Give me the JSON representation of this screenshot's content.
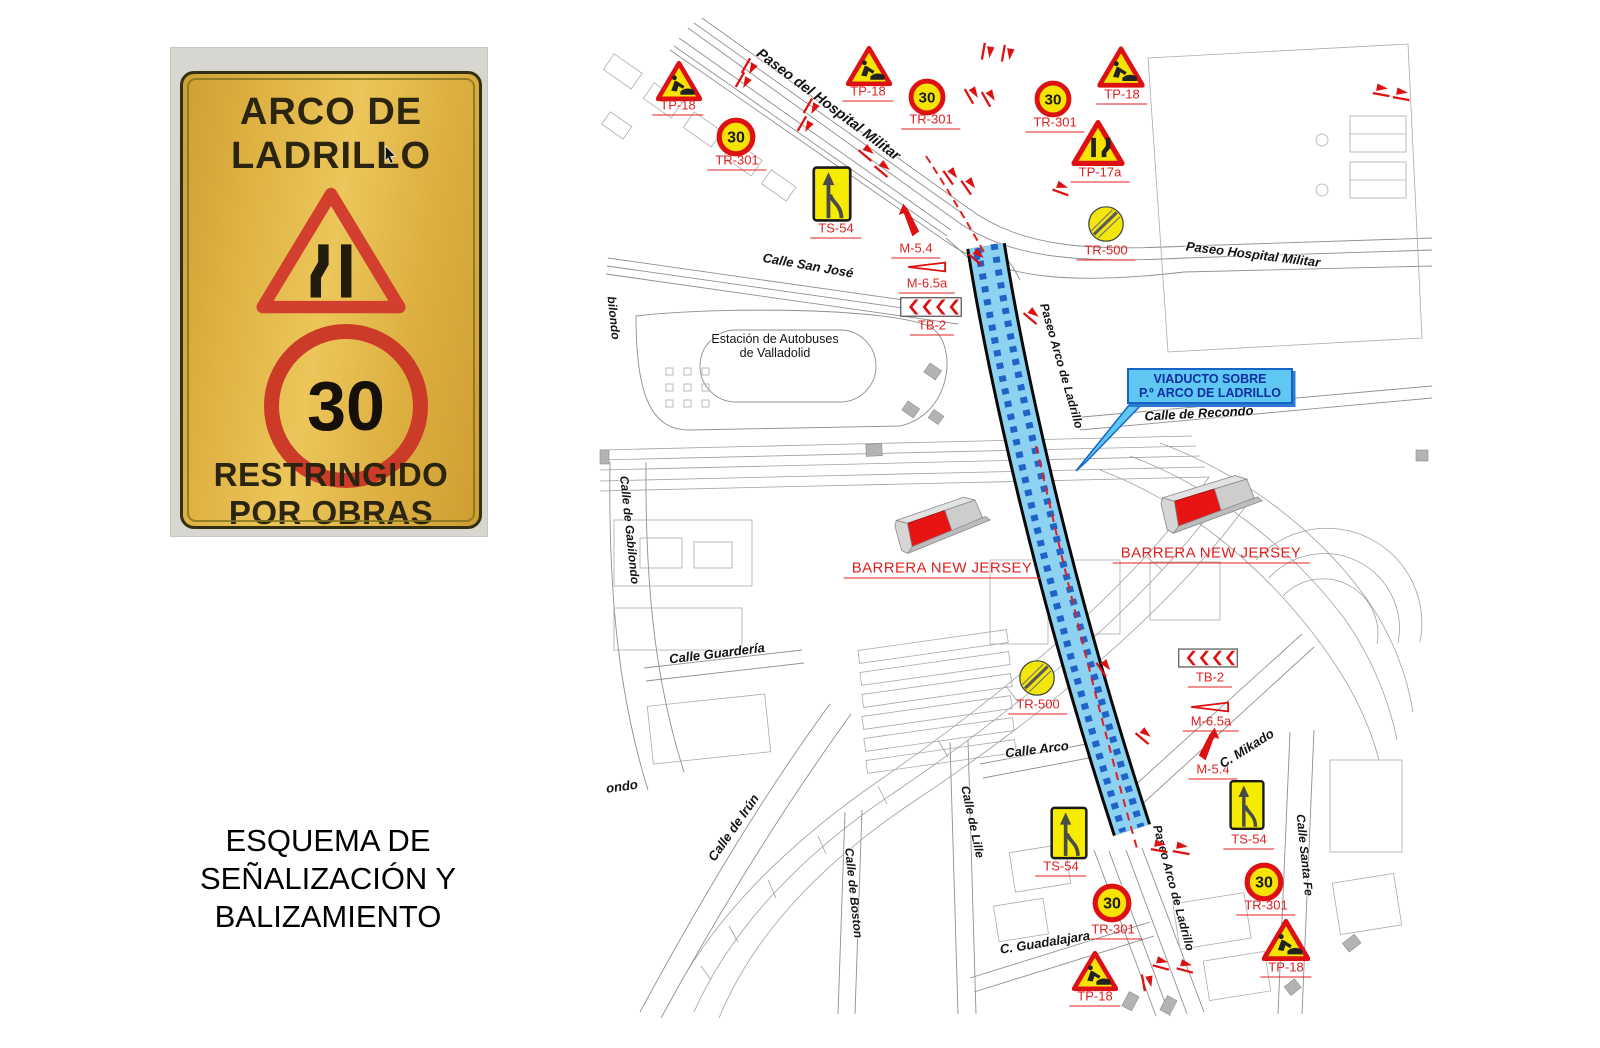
{
  "colors": {
    "accent_red": "#dd1111",
    "sign_yellow": "#f6e300",
    "label_red": "#e02020",
    "viaduct_fill": "#8ed2f2",
    "viaduct_dash": "#1f63c8",
    "callout_bg": "#5ec7f2",
    "callout_border": "#1565c8",
    "callout_text": "#122fa0",
    "barrier_red": "#e81414",
    "barrier_gray": "#cdcdcd",
    "map_line": "#9a9a9a"
  },
  "photo": {
    "title_line1": "ARCO DE",
    "title_line2": "LADRILLO",
    "speed_value": "30",
    "restricted_line1": "RESTRINGIDO",
    "restricted_line2": "POR OBRAS"
  },
  "caption": {
    "lines": [
      "ESQUEMA DE",
      "SEÑALIZACIÓN Y",
      "BALIZAMIENTO"
    ]
  },
  "map": {
    "callout": {
      "line1": "VIADUCTO SOBRE",
      "line2": "P.º ARCO DE LADRILLO"
    },
    "signs": [
      {
        "type": "tp18",
        "label": "TP-18",
        "x": 679,
        "y": 81,
        "w": 46,
        "h": 42,
        "lx": 678,
        "ly": 107
      },
      {
        "type": "tr301",
        "label": "TR-301",
        "value": "30",
        "x": 736,
        "y": 137,
        "w": 40,
        "h": 40,
        "lx": 737,
        "ly": 162
      },
      {
        "type": "tp18",
        "label": "TP-18",
        "x": 869,
        "y": 66,
        "w": 46,
        "h": 42,
        "lx": 868,
        "ly": 93
      },
      {
        "type": "tr301",
        "label": "TR-301",
        "value": "30",
        "x": 927,
        "y": 97,
        "w": 38,
        "h": 38,
        "lx": 931,
        "ly": 121
      },
      {
        "type": "tr301",
        "label": "TR-301",
        "value": "30",
        "x": 1053,
        "y": 99,
        "w": 38,
        "h": 38,
        "lx": 1055,
        "ly": 124
      },
      {
        "type": "tp18",
        "label": "TP-18",
        "x": 1121,
        "y": 67,
        "w": 47,
        "h": 43,
        "lx": 1122,
        "ly": 96
      },
      {
        "type": "tp17a",
        "label": "TP-17a",
        "x": 1098,
        "y": 143,
        "w": 53,
        "h": 48,
        "lx": 1100,
        "ly": 174
      },
      {
        "type": "ts54",
        "label": "TS-54",
        "x": 832,
        "y": 194,
        "w": 40,
        "h": 60,
        "lx": 836,
        "ly": 230
      },
      {
        "type": "m54",
        "label": "M-5.4",
        "x": 909,
        "y": 220,
        "w": 22,
        "h": 34,
        "lx": 916,
        "ly": 250
      },
      {
        "type": "m65a",
        "label": "M-6.5a",
        "x": 927,
        "y": 267,
        "w": 40,
        "h": 15,
        "lx": 927,
        "ly": 285
      },
      {
        "type": "tb2",
        "label": "TB-2",
        "x": 931,
        "y": 307,
        "w": 62,
        "h": 21,
        "lx": 932,
        "ly": 327
      },
      {
        "type": "tr500",
        "label": "TR-500",
        "x": 1106,
        "y": 224,
        "w": 40,
        "h": 40,
        "lx": 1106,
        "ly": 252
      },
      {
        "type": "tr500",
        "label": "TR-500",
        "x": 1037,
        "y": 678,
        "w": 40,
        "h": 40,
        "lx": 1038,
        "ly": 706
      },
      {
        "type": "tb2",
        "label": "TB-2",
        "x": 1208,
        "y": 658,
        "w": 60,
        "h": 20,
        "lx": 1210,
        "ly": 679
      },
      {
        "type": "m65a",
        "label": "M-6.5a",
        "x": 1210,
        "y": 707,
        "w": 40,
        "h": 15,
        "lx": 1211,
        "ly": 723
      },
      {
        "type": "m54",
        "label": "M-5.4",
        "x": 1209,
        "y": 744,
        "w": 24,
        "h": 34,
        "flip": true,
        "lx": 1213,
        "ly": 771
      },
      {
        "type": "ts54",
        "label": "TS-54",
        "x": 1069,
        "y": 833,
        "w": 38,
        "h": 58,
        "lx": 1061,
        "ly": 868
      },
      {
        "type": "ts54",
        "label": "TS-54",
        "x": 1247,
        "y": 805,
        "w": 36,
        "h": 54,
        "lx": 1249,
        "ly": 841
      },
      {
        "type": "tr301",
        "label": "TR-301",
        "value": "30",
        "x": 1112,
        "y": 903,
        "w": 40,
        "h": 40,
        "lx": 1113,
        "ly": 931
      },
      {
        "type": "tr301",
        "label": "TR-301",
        "value": "30",
        "x": 1264,
        "y": 882,
        "w": 40,
        "h": 40,
        "lx": 1266,
        "ly": 907
      },
      {
        "type": "tp18",
        "label": "TP-18",
        "x": 1095,
        "y": 971,
        "w": 46,
        "h": 42,
        "lx": 1095,
        "ly": 998
      },
      {
        "type": "tp18",
        "label": "TP-18",
        "x": 1286,
        "y": 940,
        "w": 48,
        "h": 44,
        "lx": 1286,
        "ly": 969
      }
    ],
    "barriers": [
      {
        "label": "BARRERA NEW JERSEY",
        "x": 941,
        "y": 521,
        "w": 100,
        "h": 58,
        "rot": -19,
        "lx": 942,
        "ly": 570
      },
      {
        "label": "BARRERA NEW JERSEY",
        "x": 1210,
        "y": 500,
        "w": 106,
        "h": 60,
        "rot": -17,
        "lx": 1211,
        "ly": 555
      }
    ],
    "streets": [
      {
        "text": "Paseo del Hospital Militar",
        "x": 828,
        "y": 105,
        "rot": 37,
        "size": 14.5
      },
      {
        "text": "Paseo Hospital Militar",
        "x": 1253,
        "y": 255,
        "rot": 7,
        "size": 13
      },
      {
        "text": "Calle San José",
        "x": 808,
        "y": 266,
        "rot": 10,
        "size": 13
      },
      {
        "text": "Estación de Autobuses\nde Valladolid",
        "x": 775,
        "y": 346,
        "rot": 0,
        "size": 12.5,
        "plain": true
      },
      {
        "text": "Calle de Recondo",
        "x": 1199,
        "y": 414,
        "rot": -3,
        "size": 13
      },
      {
        "text": "Calle de Gabilondo",
        "x": 629,
        "y": 530,
        "rot": 84,
        "size": 12
      },
      {
        "text": "Calle Guardería",
        "x": 717,
        "y": 654,
        "rot": -7,
        "size": 13
      },
      {
        "text": "ondo",
        "x": 622,
        "y": 787,
        "rot": -8,
        "size": 13
      },
      {
        "text": "Calle de Irún",
        "x": 734,
        "y": 828,
        "rot": -55,
        "size": 13
      },
      {
        "text": "Calle de Boston",
        "x": 853,
        "y": 893,
        "rot": 84,
        "size": 12
      },
      {
        "text": "Calle de Lille",
        "x": 972,
        "y": 822,
        "rot": 78,
        "size": 12
      },
      {
        "text": "Calle Arco",
        "x": 1037,
        "y": 750,
        "rot": -7,
        "size": 13
      },
      {
        "text": "C. Mikado",
        "x": 1247,
        "y": 749,
        "rot": -32,
        "size": 13
      },
      {
        "text": "C. Guadalajara",
        "x": 1045,
        "y": 943,
        "rot": -9,
        "size": 13
      },
      {
        "text": "Calle Santa Fe",
        "x": 1304,
        "y": 855,
        "rot": 84,
        "size": 12
      },
      {
        "text": "Paseo Arco de Ladrillo",
        "x": 1061,
        "y": 366,
        "rot": 74,
        "size": 12
      },
      {
        "text": "Paseo Arco de Ladrillo",
        "x": 1173,
        "y": 888,
        "rot": 75,
        "size": 12
      },
      {
        "text": "bilondo",
        "x": 613,
        "y": 318,
        "rot": 84,
        "size": 12
      }
    ],
    "markers": [
      {
        "x": 750,
        "y": 68,
        "rot": 120
      },
      {
        "x": 744,
        "y": 82,
        "rot": 120
      },
      {
        "x": 812,
        "y": 108,
        "rot": 120
      },
      {
        "x": 806,
        "y": 126,
        "rot": 120
      },
      {
        "x": 868,
        "y": 152,
        "rot": 40
      },
      {
        "x": 884,
        "y": 168,
        "rot": 40
      },
      {
        "x": 988,
        "y": 52,
        "rot": 100
      },
      {
        "x": 1008,
        "y": 54,
        "rot": 100
      },
      {
        "x": 973,
        "y": 94,
        "rot": 60
      },
      {
        "x": 990,
        "y": 97,
        "rot": 60
      },
      {
        "x": 952,
        "y": 175,
        "rot": 55
      },
      {
        "x": 970,
        "y": 185,
        "rot": 55
      },
      {
        "x": 1062,
        "y": 188,
        "rot": 20
      },
      {
        "x": 1382,
        "y": 90,
        "rot": 10
      },
      {
        "x": 1402,
        "y": 94,
        "rot": 10
      },
      {
        "x": 978,
        "y": 256,
        "rot": 40
      },
      {
        "x": 1033,
        "y": 315,
        "rot": 40
      },
      {
        "x": 1105,
        "y": 667,
        "rot": 55
      },
      {
        "x": 1145,
        "y": 735,
        "rot": 40
      },
      {
        "x": 1160,
        "y": 846,
        "rot": 10
      },
      {
        "x": 1182,
        "y": 848,
        "rot": 10
      },
      {
        "x": 1162,
        "y": 963,
        "rot": 15
      },
      {
        "x": 1186,
        "y": 966,
        "rot": 15
      },
      {
        "x": 1148,
        "y": 982,
        "rot": 80
      }
    ]
  }
}
